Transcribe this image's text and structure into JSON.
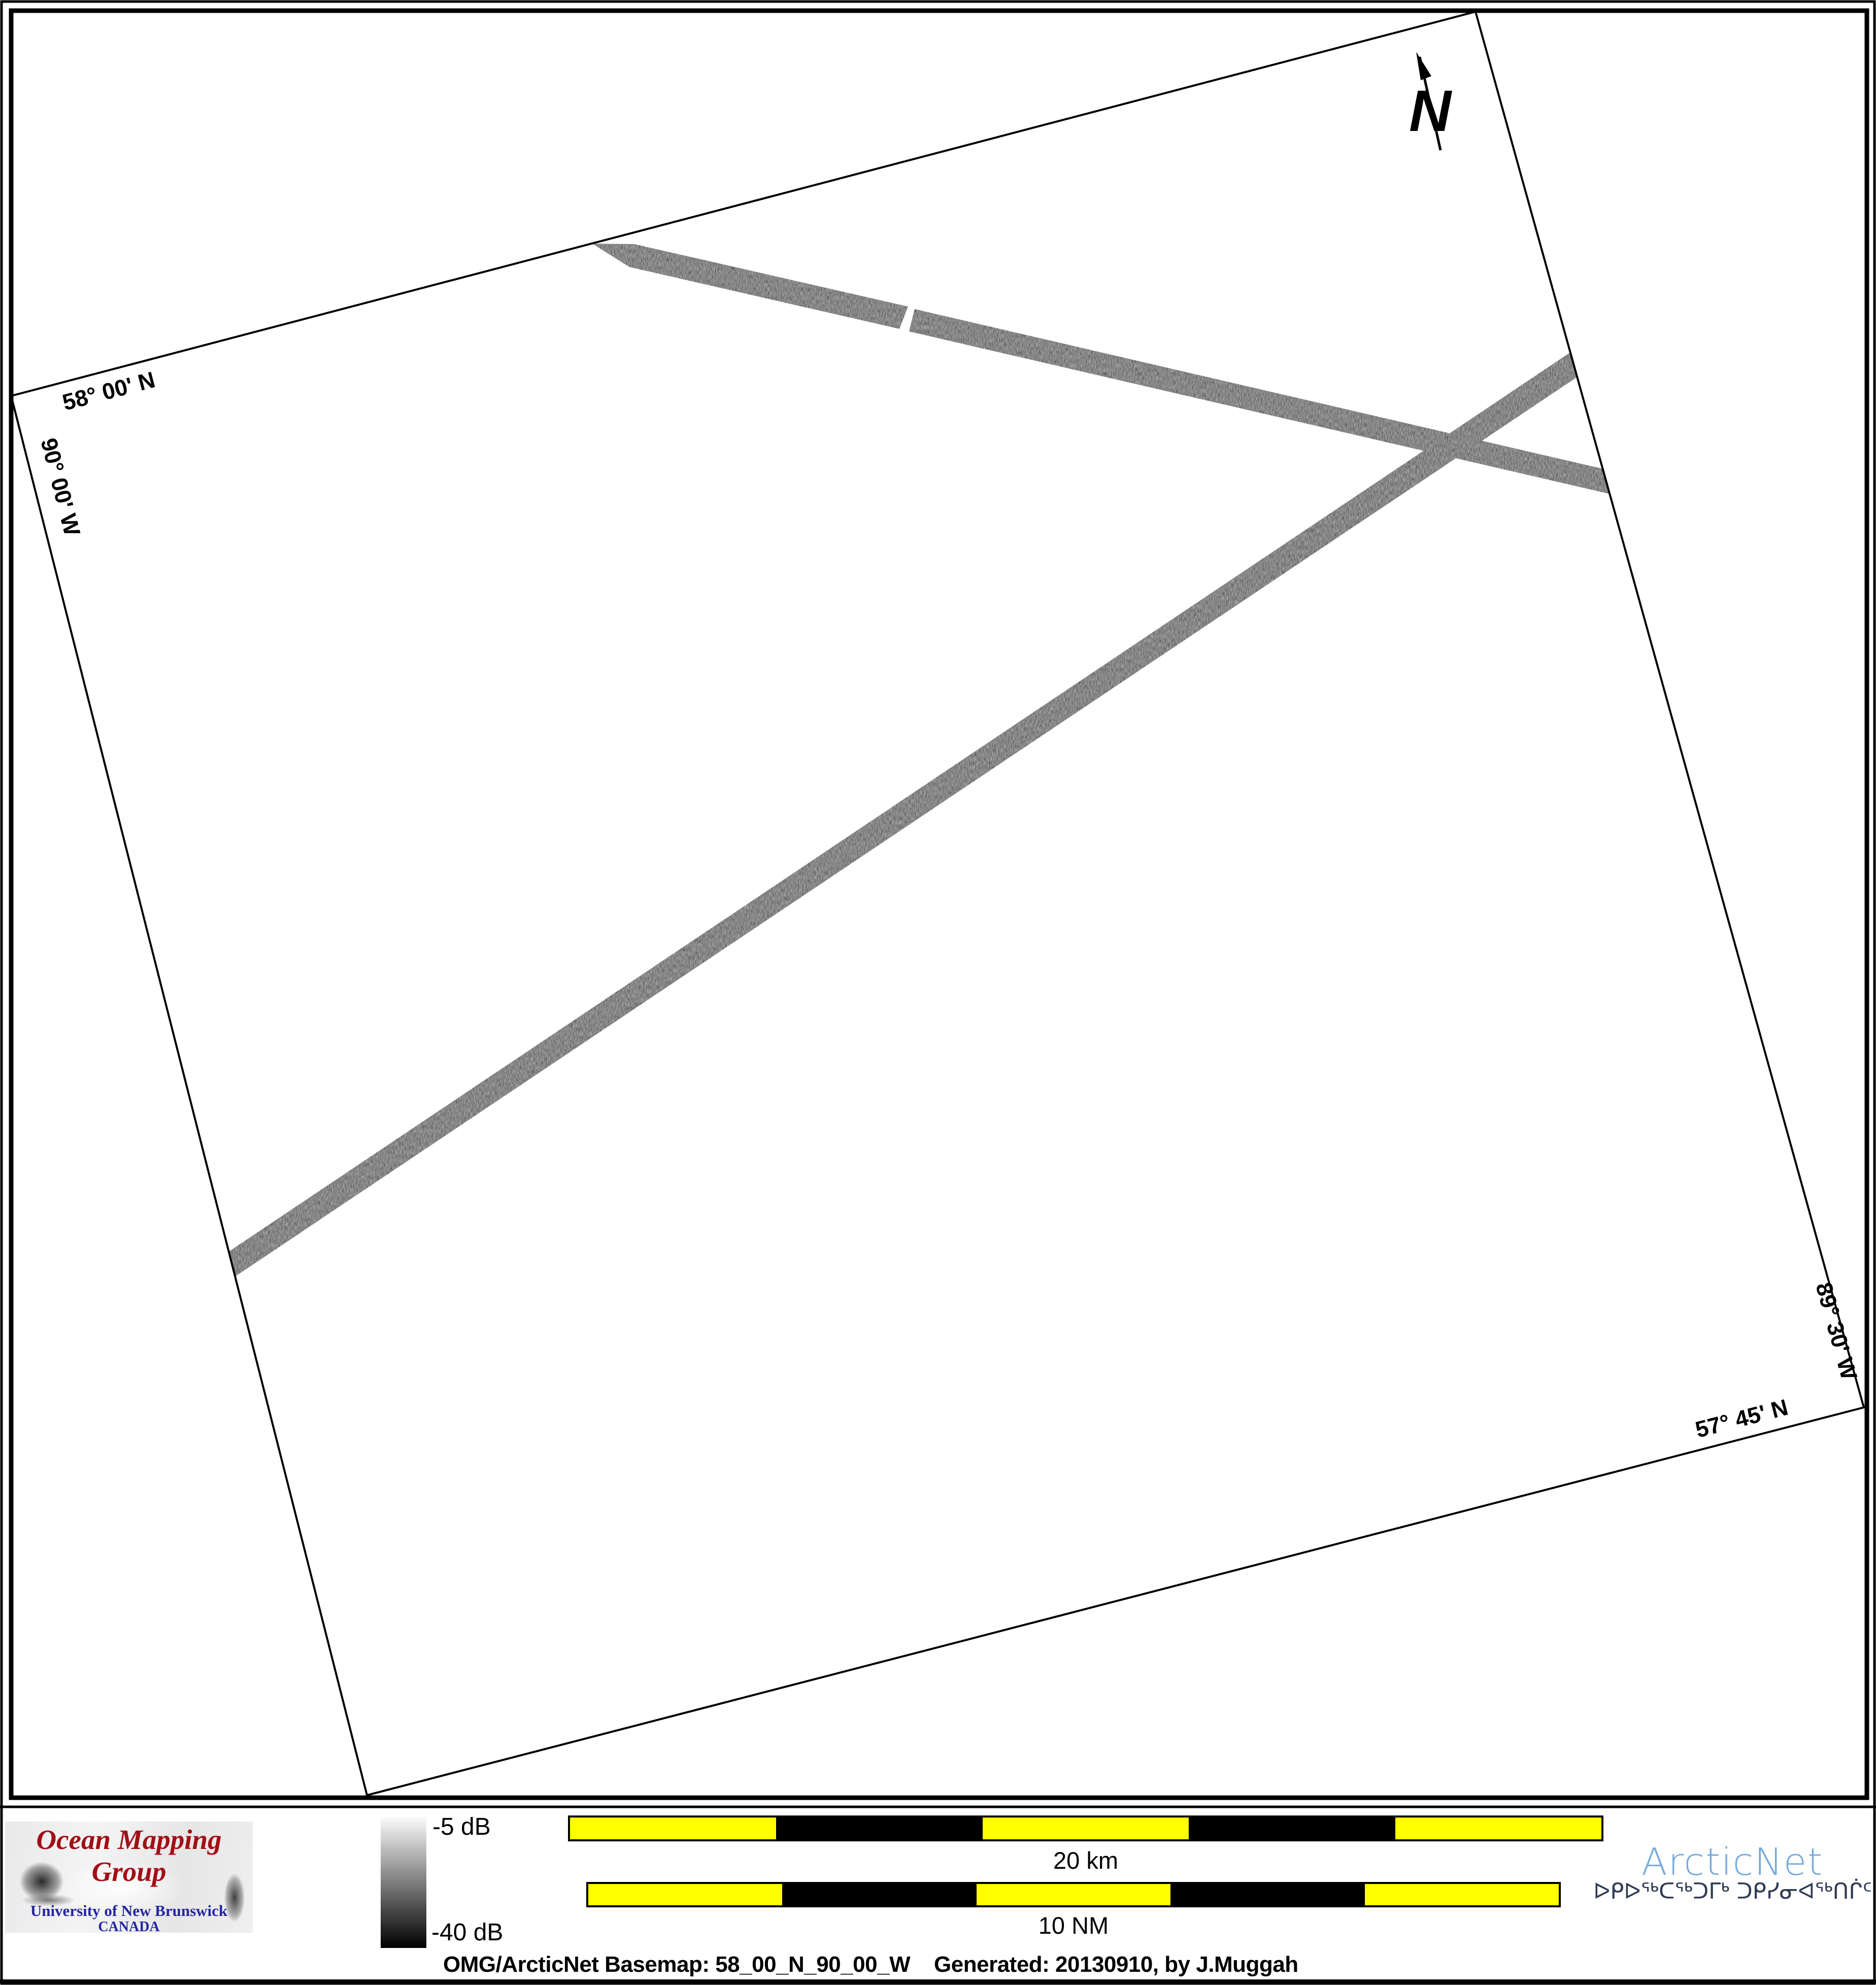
{
  "map": {
    "labels": {
      "lat_top": "58° 00' N",
      "lon_left": "90° 00' W",
      "lon_right": "89° 30' W",
      "lat_bottom": "57° 45' N"
    },
    "north_arrow_label": "N"
  },
  "legend": {
    "omg_logo": {
      "title": "Ocean Mapping Group",
      "university": "University of New Brunswick",
      "country": "CANADA",
      "title_color": "#a30e16",
      "text_color": "#2525a5"
    },
    "colorbar": {
      "label_top": "-5 dB",
      "label_bottom": "-40 dB",
      "color_top": "#fbfbfb",
      "color_bottom": "#000000"
    },
    "scalebar_km": {
      "label": "20 km",
      "segment_colors": [
        "#ffff00",
        "#000000",
        "#ffff00",
        "#000000",
        "#ffff00"
      ]
    },
    "scalebar_nm": {
      "label": "10 NM",
      "segment_colors": [
        "#ffff00",
        "#000000",
        "#ffff00",
        "#000000",
        "#ffff00"
      ]
    },
    "arcticnet": {
      "name": "ArcticNet",
      "inuktitut": "ᐅᑭᐅᖅᑕᖅᑐᒥᒃ ᑐᑭᓯᓂᐊᖅᑎᒌᑦ",
      "name_color": "#77aada",
      "inuktitut_color": "#2e3c52"
    }
  },
  "caption": "OMG/ArcticNet Basemap: 58_00_N_90_00_W    Generated: 20130910, by J.Muggah",
  "swath_color": "#b0b0b0"
}
